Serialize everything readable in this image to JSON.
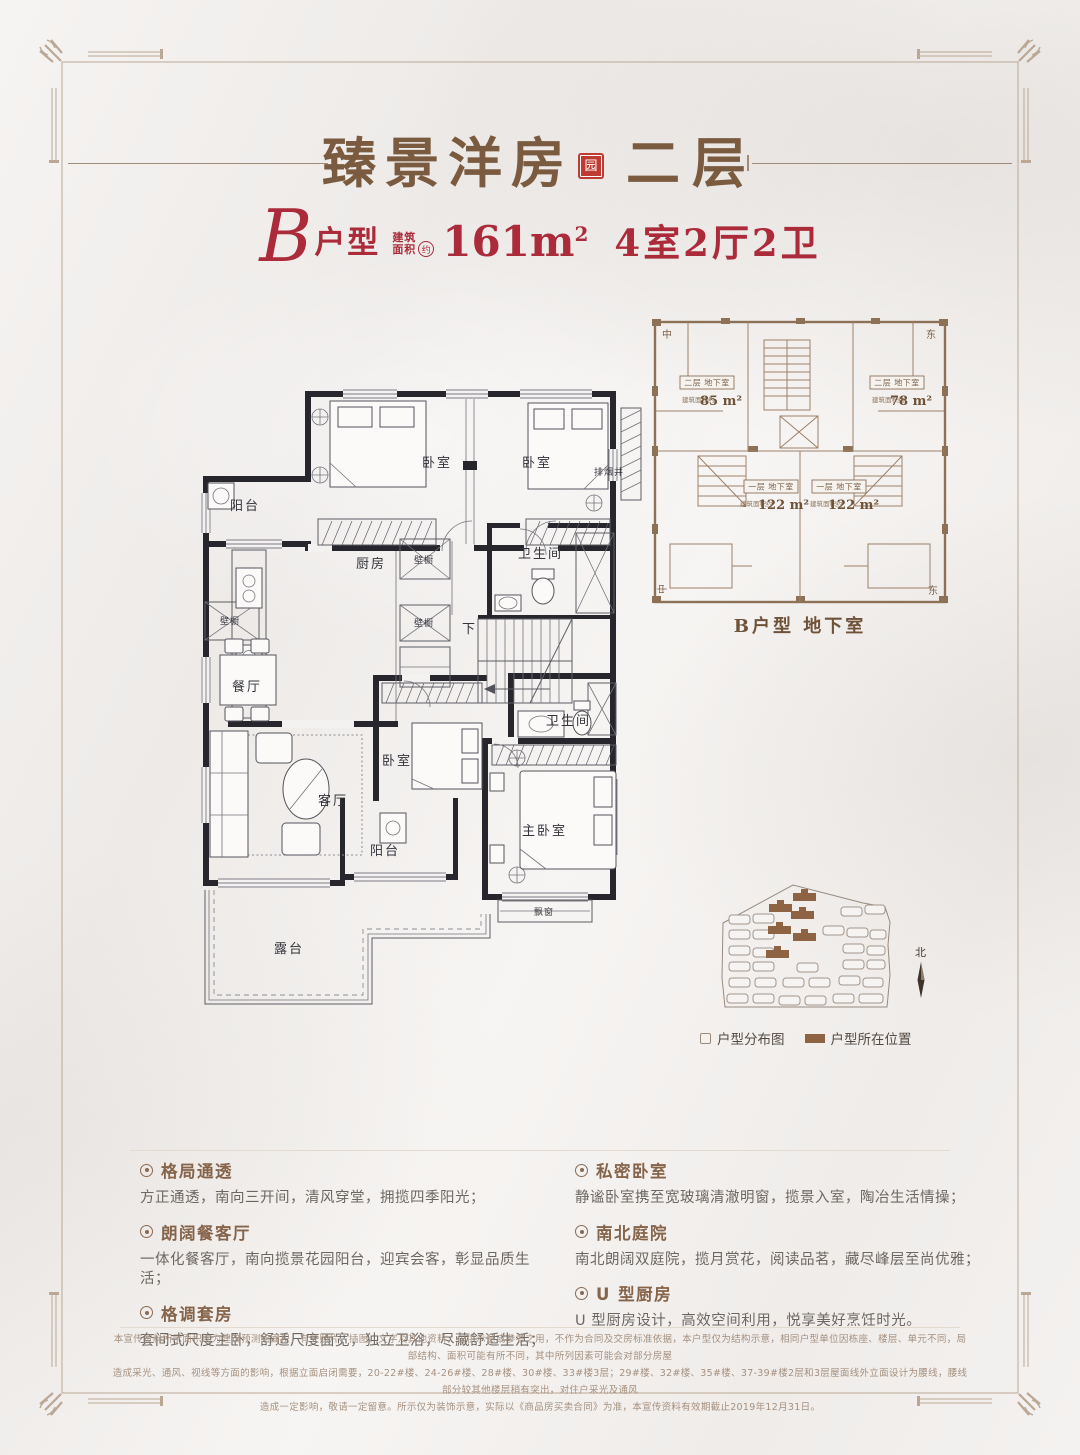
{
  "header": {
    "title": "臻景洋房",
    "seal_char": "园",
    "floor_label": "二层"
  },
  "unit_bar": {
    "letter": "B",
    "type_label": "户型",
    "area_label_top": "建筑",
    "area_label_bottom": "面积",
    "area_approx": "约",
    "area_value": "161m",
    "area_sup": "2",
    "rooms_label": "4室2厅2卫"
  },
  "main_plan": {
    "labels": {
      "balcony_top": "阳台",
      "bedroom_top_left": "卧室",
      "bedroom_top_right": "卧室",
      "exhaust_shaft": "排烟井",
      "kitchen": "厨房",
      "closet_kitchen_1": "壁橱",
      "closet_kitchen_2": "壁橱",
      "bath_upper": "卫生间",
      "stairs_down": "下",
      "closet_dining": "壁橱",
      "dining": "餐厅",
      "living": "客厅",
      "bedroom_mid": "卧室",
      "balcony_south": "阳台",
      "master_bedroom": "主卧室",
      "bath_lower": "卫生间",
      "bay_window": "飘窗",
      "terrace": "露台"
    }
  },
  "basement_plan": {
    "corner_top_left": "中",
    "corner_top_right": "东",
    "corner_bottom_left": "中",
    "corner_bottom_right": "东",
    "units": [
      {
        "name": "二层 地下室",
        "area_prefix": "建筑面积约",
        "area": "85 m²"
      },
      {
        "name": "二层 地下室",
        "area_prefix": "建筑面积约",
        "area": "78 m²"
      },
      {
        "name": "一层 地下室",
        "area_prefix": "建筑面积约",
        "area": "122 m²"
      },
      {
        "name": "一层 地下室",
        "area_prefix": "建筑面积约",
        "area": "122 m²"
      }
    ],
    "caption": "B户型 地下室"
  },
  "site_map": {
    "north_label": "北",
    "legend_distribution": "户型分布图",
    "legend_location": "户型所在位置"
  },
  "features": {
    "left": [
      {
        "title": "格局通透",
        "desc": "方正通透，南向三开间，清风穿堂，拥揽四季阳光；"
      },
      {
        "title": "朗阔餐客厅",
        "desc": "一体化餐客厅，南向揽景花园阳台，迎宾会客，彰显品质生活；"
      },
      {
        "title": "格调套房",
        "desc": "套间式尺度主卧，舒适尺度面宽，独立卫浴，尽藏舒适生活；"
      }
    ],
    "right": [
      {
        "title": "私密卧室",
        "desc": "静谧卧室携至宽玻璃清澈明窗，揽景入室，陶冶生活情操；"
      },
      {
        "title": "南北庭院",
        "desc": "南北朗阔双庭院，揽月赏花，阅读品茗，藏尽峰层至尚优雅；"
      },
      {
        "title": "U 型厨房",
        "desc": "U 型厨房设计，高效空间利用，悦享美好烹饪时光。"
      }
    ]
  },
  "disclaimer": {
    "line1": "本宣传资料所示面积均为建筑预测绘面积，有关照片、插图、文字及其他资料，仅供示意或参考之用，不作为合同及交房标准依据，本户型仅为结构示意，相同户型单位因栋座、楼层、单元不同，局部结构、面积可能有所不同，其中所列因素可能会对部分房屋",
    "line2": "造成采光、通风、视线等方面的影响，根据立面启闭需要，20-22#楼、24-26#楼、28#楼、30#楼、33#楼3层；29#楼、32#楼、35#楼、37-39#楼2层和3层屋面线外立面设计为腰线，腰线部分较其他楼层稍有突出，对住户采光及通风",
    "line3": "造成一定影响，敬请一定留意。所示仅为装饰示意，实际以《商品房买卖合同》为准，本宣传资料有效期截止2019年12月31日。"
  }
}
